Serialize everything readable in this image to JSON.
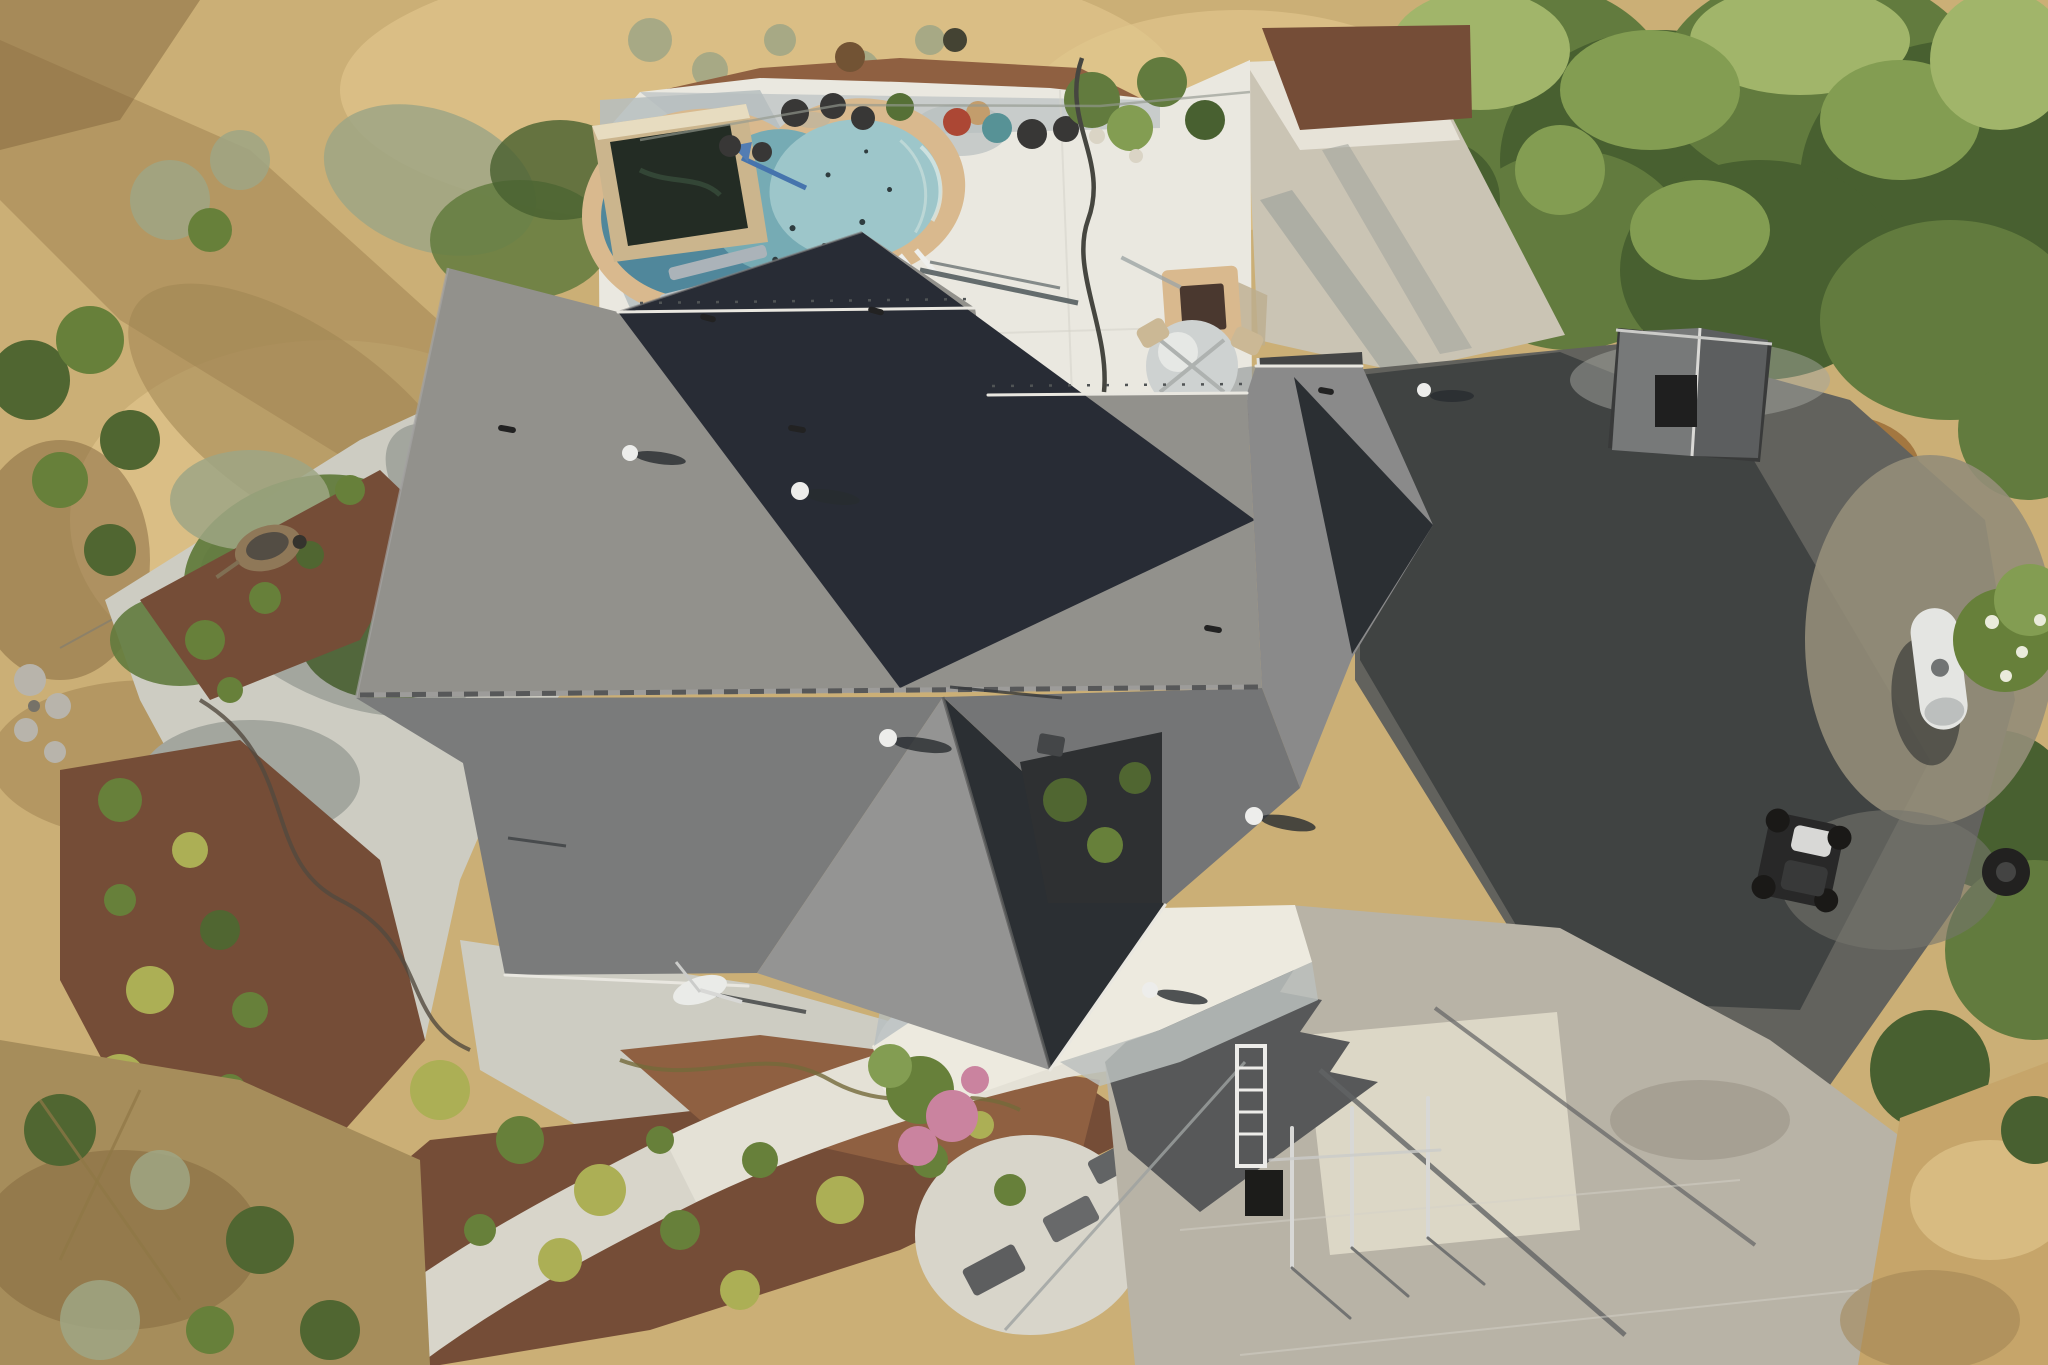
{
  "scene": {
    "type": "aerial-drone-photo",
    "description": "Top-down aerial view of a large single-story house with a dark gray composition-shingle hip roof, backyard kidney-shaped swimming pool with tan coping on a white concrete pool deck, koi pond, picnic table, fire pit, patio table with chairs, gravel and red-mulch landscaping with round shrubs, dry golden grass hillside on the left, dense green trees on the upper right, shaded asphalt driveway with propane tank, ATV and shed on the right, and a bright concrete driveway pad at the lower right.",
    "lighting": "low sun from the west; shadows cast toward the east/right",
    "elements": [
      "house-roof",
      "swimming-pool",
      "pool-deck",
      "koi-pond",
      "picnic-table",
      "fire-pit",
      "patio-table",
      "planter-pots",
      "satellite-dish",
      "roof-vents",
      "propane-tank",
      "atv",
      "shed",
      "pergola-deck",
      "gravel-path",
      "mulch-beds",
      "shrubs",
      "trees",
      "dry-grass",
      "driveway",
      "concrete-pad",
      "walkway",
      "trellis",
      "garden-hose",
      "wheelbarrow",
      "fence"
    ]
  },
  "palette": {
    "grass_base": "#c9ad74",
    "grass_light": "#e0c68e",
    "grass_shadow": "#9a7f4e",
    "grass_deep_shadow": "#7c5f38",
    "sage": "#9aa384",
    "tree_dark": "#3f5a2b",
    "tree_mid": "#5a7739",
    "tree_light": "#7d9a4e",
    "tree_sun": "#9cb468",
    "gravel": "#cbccc5",
    "gravel_shadow": "#9fa49f",
    "gravel_bright": "#dddcd4",
    "white_path": "#e3e2da",
    "mulch": "#6e4632",
    "mulch_light": "#8a5a3d",
    "shrub_yellow": "#a8ad52",
    "shrub_green": "#5f7c35",
    "shrub_dark": "#47602c",
    "deck": "#e9e9e4",
    "deck_shadow": "#b3bdc2",
    "coping": "#d7b88e",
    "pool_deep": "#47839b",
    "pool_mid": "#6fa9b6",
    "pool_shallow": "#98c6cd",
    "pond_water": "#18231e",
    "pond_wall": "#c9b48d",
    "roof_north": "#8d8e8c",
    "roof_south": "#73767a",
    "roof_south2": "#6d7074",
    "roof_gable_west": "#8f9193",
    "roof_right": "#84868a",
    "roof_dark": "#1d2330",
    "roof_dark2": "#20262e",
    "porch_dark": "#23282d",
    "ridge": "#4f5256",
    "fascia": "#e8e8e4",
    "asphalt": "#5a5c5a",
    "asphalt_shadow": "#33383c",
    "dirt_sun": "#8e8977",
    "concrete": "#b5b1a7",
    "concrete_bright": "#dbd7c9",
    "concrete_shadow": "#4e5256",
    "white": "#eceff0",
    "metal": "#d6d9da",
    "propane": "#e3e6e6",
    "flower_pink": "#c87fa0",
    "pot_red": "#a8402f",
    "pot_teal": "#4f8f96",
    "pot_dark": "#2e2f31",
    "table_blue": "#b9c4cb",
    "tan_furniture": "#c9b795",
    "hose": "#3d3f3b",
    "rock": "#b5b3ac"
  }
}
